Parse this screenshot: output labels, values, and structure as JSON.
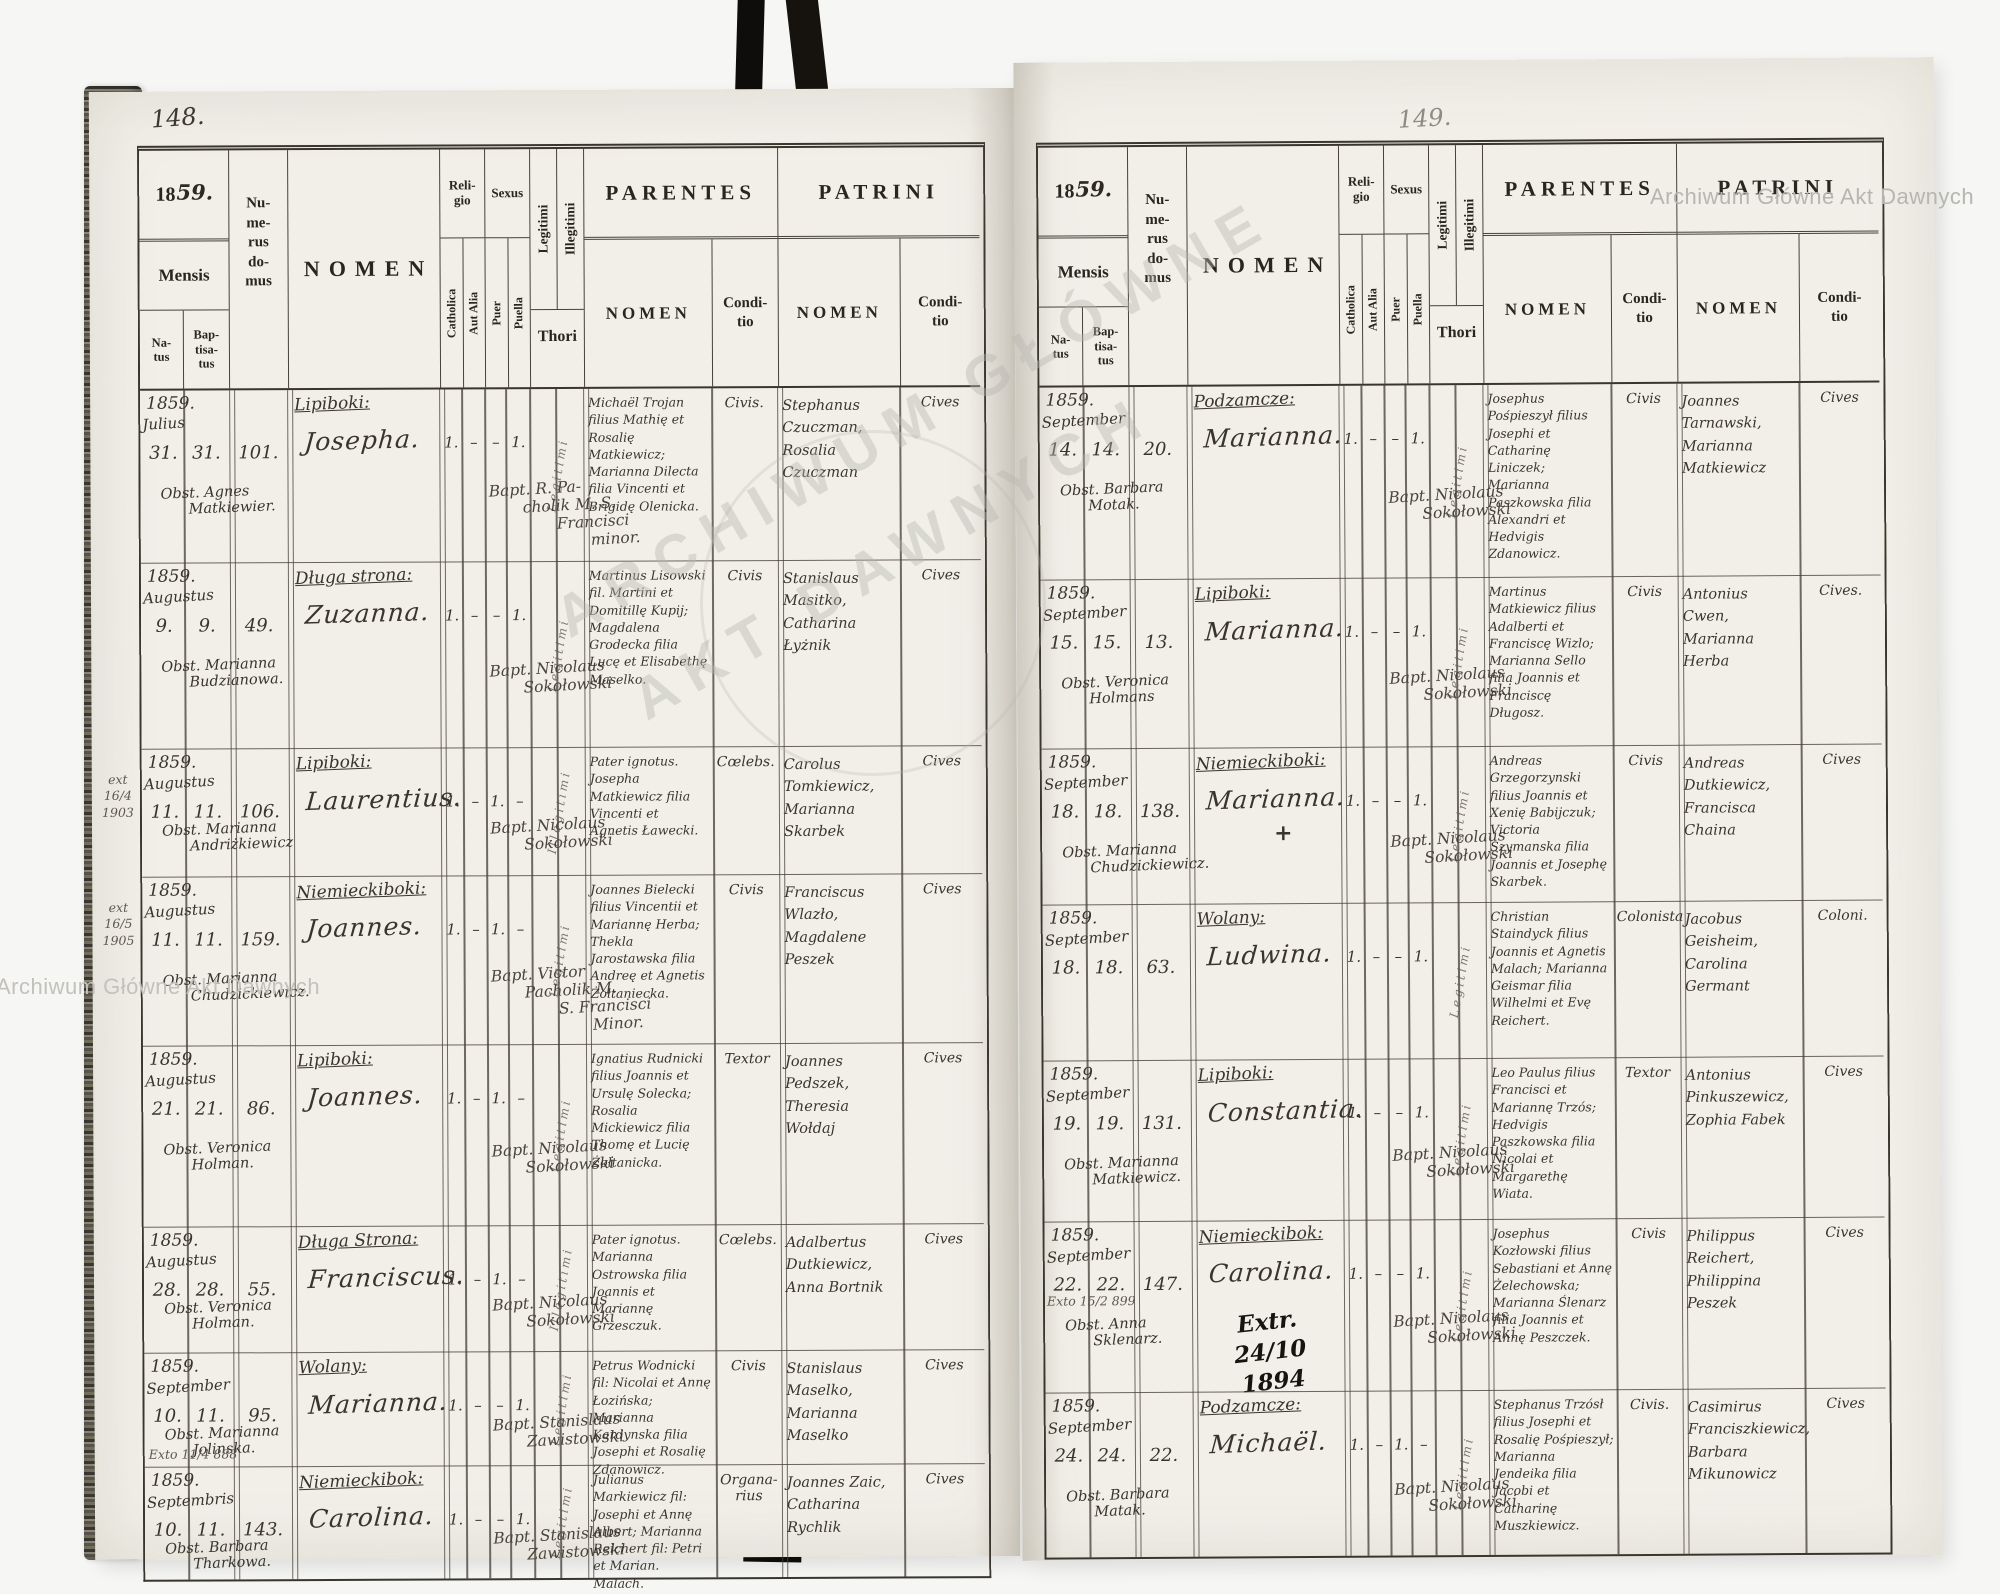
{
  "document_title": "Parish baptismal register 1859 (Latin), two-page spread",
  "colors": {
    "paper": "#f1efe8",
    "ink_print": "#29261f",
    "ink_hand": "#39352c",
    "watermark": "#b7b5b0"
  },
  "watermark": {
    "full": "Archiwum Główne Akt Dawnych",
    "center_line1": "ARCHIWUM GŁÓWNE",
    "center_line2": "AKT DAWNYCH"
  },
  "headers": {
    "year_printed": "18",
    "year_hand": "59.",
    "mensis": "Mensis",
    "natus_lines": [
      "Na-",
      "tus"
    ],
    "baptisatus_lines": [
      "Bap-",
      "tisa-",
      "tus"
    ],
    "numerus_domus_lines": [
      "Nu-",
      "me-",
      "rus",
      "do-",
      "mus"
    ],
    "nomen": "NOMEN",
    "religio_lines": [
      "Reli-",
      "gio"
    ],
    "catholica": "Catholica",
    "aut_alia": "Aut Alia",
    "sexus": "Sexus",
    "puer": "Puer",
    "puella": "Puella",
    "legitimi": "Legitimi",
    "illegitimi": "Illegitimi",
    "thori": "Thori",
    "parentes": "PARENTES",
    "patrini": "PATRINI",
    "conditio_lines": [
      "Condi-",
      "tio"
    ]
  },
  "left_page": {
    "page_number": "148.",
    "rows": [
      {
        "year": "1859.",
        "month": "Julius",
        "natus": "31.",
        "baptisatus": "31.",
        "domus": "101.",
        "locality": "Lipiboki:",
        "name": "Josepha.",
        "obstetrix": [
          "Obst. Agnes",
          "Matkiewier."
        ],
        "marks": {
          "catholica": "1.",
          "aut_alia": "–",
          "puer": "–",
          "puella": "1."
        },
        "thori_note": "Legitimi",
        "baptizer": [
          "Bapt. R. Pa-",
          "cholik M. S.",
          "Francisci",
          "minor."
        ],
        "parentes_nomen": "Michaël Trojan filius Mathię et Rosalię Matkiewicz; Marianna Dilecta filia Vincenti et Brigidę Olenicka.",
        "parentes_conditio": "Civis.",
        "patrini_nomen": "Stephanus Czuczman, Rosalia Czuczman",
        "patrini_conditio": "Cives"
      },
      {
        "year": "1859.",
        "month": "Augustus",
        "natus": "9.",
        "baptisatus": "9.",
        "domus": "49.",
        "locality": "Długa strona:",
        "name": "Zuzanna.",
        "obstetrix": [
          "Obst. Marianna",
          "Budzianowa."
        ],
        "marks": {
          "catholica": "1.",
          "aut_alia": "–",
          "puer": "–",
          "puella": "1."
        },
        "thori_note": "Legitimi",
        "baptizer": [
          "Bapt. Nicolaus",
          "Sokołowski"
        ],
        "parentes_nomen": "Martinus Lisowski fil. Martini et Domitillę Kupij; Magdalena Grodecka filia Lucę et Elisabethę Maselko.",
        "parentes_conditio": "Civis",
        "patrini_nomen": "Stanislaus Masitko, Catharina Łyżnik",
        "patrini_conditio": "Cives"
      },
      {
        "margin": {
          "lines": [
            "ext",
            "16/4",
            "1903"
          ],
          "placement": "side"
        },
        "year": "1859.",
        "month": "Augustus",
        "natus": "11.",
        "baptisatus": "11.",
        "domus": "106.",
        "locality": "Lipiboki:",
        "name": "Laurentius.",
        "obstetrix": [
          "Obst. Marianna",
          "Andriżkiewicz"
        ],
        "marks": {
          "catholica": "1.",
          "aut_alia": "–",
          "puer": "1.",
          "puella": "–"
        },
        "thori_note": "Illegitimi",
        "baptizer": [
          "Bapt. Nicolaus",
          "Sokołowski"
        ],
        "parentes_nomen": "Pater ignotus. Josepha Matkiewicz filia Vincenti et Agnetis Ławecki.",
        "parentes_conditio": "Cœlebs.",
        "patrini_nomen": "Carolus Tomkiewicz, Marianna Skarbek",
        "patrini_conditio": "Cives"
      },
      {
        "margin": {
          "lines": [
            "ext",
            "16/5",
            "1905"
          ],
          "placement": "side"
        },
        "year": "1859.",
        "month": "Augustus",
        "natus": "11.",
        "baptisatus": "11.",
        "domus": "159.",
        "locality": "Niemieckiboki:",
        "name": "Joannes.",
        "obstetrix": [
          "Obst. Marianna",
          "Chudzickiewicz."
        ],
        "marks": {
          "catholica": "1.",
          "aut_alia": "–",
          "puer": "1.",
          "puella": "–"
        },
        "thori_note": "Legitimi",
        "baptizer": [
          "Bapt. Victor",
          "Pacholik M.",
          "S. Francisci",
          "Minor."
        ],
        "parentes_nomen": "Joannes Bielecki filius Vincentii et Mariannę Herba; Thekla Jarostawska filia Andreę et Agnetis Żołtaniecka.",
        "parentes_conditio": "Civis",
        "patrini_nomen": "Franciscus Wlazło, Magdalene Peszek",
        "patrini_conditio": "Cives"
      },
      {
        "year": "1859.",
        "month": "Augustus",
        "natus": "21.",
        "baptisatus": "21.",
        "domus": "86.",
        "locality": "Lipiboki:",
        "name": "Joannes.",
        "obstetrix": [
          "Obst. Veronica",
          "Holman."
        ],
        "marks": {
          "catholica": "1.",
          "aut_alia": "–",
          "puer": "1.",
          "puella": "–"
        },
        "thori_note": "Legitimi",
        "baptizer": [
          "Bapt. Nicolaus",
          "Sokołowski"
        ],
        "parentes_nomen": "Ignatius Rudnicki filius Joannis et Ursulę Solecka; Rosalia Mickiewicz filia Thomę et Lucię Żołtanicka.",
        "parentes_conditio": "Textor",
        "patrini_nomen": "Joannes Pedszek, Theresia Wołdaj",
        "patrini_conditio": "Cives"
      },
      {
        "year": "1859.",
        "month": "Augustus",
        "natus": "28.",
        "baptisatus": "28.",
        "domus": "55.",
        "locality": "Długa Strona:",
        "name": "Franciscus.",
        "obstetrix": [
          "Obst. Veronica",
          "Holman."
        ],
        "marks": {
          "catholica": "1.",
          "aut_alia": "–",
          "puer": "1.",
          "puella": "–"
        },
        "thori_note": "Illegitimi",
        "baptizer": [
          "Bapt. Nicolaus",
          "Sokołowski"
        ],
        "parentes_nomen": "Pater ignotus. Marianna Ostrowska filia Joannis et Mariannę Grzesczuk.",
        "parentes_conditio": "Cœlebs.",
        "patrini_nomen": "Adalbertus Dutkiewicz, Anna Bortnik",
        "patrini_conditio": "Cives"
      },
      {
        "margin": {
          "lines": [
            "Exto 11/4 888"
          ],
          "placement": "below"
        },
        "year": "1859.",
        "month": "September",
        "natus": "10.",
        "baptisatus": "11.",
        "domus": "95.",
        "locality": "Wolany:",
        "name": "Marianna.",
        "obstetrix": [
          "Obst. Marianna",
          "Jolinska."
        ],
        "marks": {
          "catholica": "1.",
          "aut_alia": "–",
          "puer": "–",
          "puella": "1."
        },
        "thori_note": "Legitimi",
        "baptizer": [
          "Bapt. Stanislaus",
          "Zawistowski"
        ],
        "parentes_nomen": "Petrus Wodnicki fil: Nicolai et Annę Łozińska; Marianna Kardynska filia Josephi et Rosalię Zdanowicz.",
        "parentes_conditio": "Civis",
        "patrini_nomen": "Stanislaus Maselko, Marianna Maselko",
        "patrini_conditio": "Cives"
      },
      {
        "year": "1859.",
        "month": "Septembris",
        "natus": "10.",
        "baptisatus": "11.",
        "domus": "143.",
        "locality": "Niemieckibok:",
        "name": "Carolina.",
        "obstetrix": [
          "Obst. Barbara",
          "Tharkowa."
        ],
        "marks": {
          "catholica": "1.",
          "aut_alia": "–",
          "puer": "–",
          "puella": "1."
        },
        "thori_note": "Legitimi",
        "baptizer": [
          "Bapt. Stanislaus",
          "Zawistowski"
        ],
        "parentes_nomen": "Julianus Markiewicz fil: Josephi et Annę Albert; Marianna Reichert fil: Petri et Marian. Malach.",
        "parentes_conditio": "Organa- rius",
        "patrini_nomen": "Joannes Zaic, Catharina Rychlik",
        "patrini_conditio": "Cives"
      }
    ]
  },
  "right_page": {
    "page_number": "149.",
    "rows": [
      {
        "year": "1859.",
        "month": "September",
        "natus": "14.",
        "baptisatus": "14.",
        "domus": "20.",
        "locality": "Podzamcze:",
        "name": "Marianna.",
        "obstetrix": [
          "Obst. Barbara",
          "Motak."
        ],
        "marks": {
          "catholica": "1.",
          "aut_alia": "–",
          "puer": "–",
          "puella": "1."
        },
        "thori_note": "Legitimi",
        "baptizer": [
          "Bapt. Nicolaus",
          "Sokołowski"
        ],
        "parentes_nomen": "Josephus Pośpieszył filius Josephi et Catharinę Liniczek; Marianna Paszkowska filia Alexandri et Hedvigis Zdanowicz.",
        "parentes_conditio": "Civis",
        "patrini_nomen": "Joannes Tarnawski, Marianna Matkiewicz",
        "patrini_conditio": "Cives"
      },
      {
        "year": "1859.",
        "month": "September",
        "natus": "15.",
        "baptisatus": "15.",
        "domus": "13.",
        "locality": "Lipiboki:",
        "name": "Marianna.",
        "obstetrix": [
          "Obst. Veronica",
          "Holmans"
        ],
        "marks": {
          "catholica": "1.",
          "aut_alia": "–",
          "puer": "–",
          "puella": "1."
        },
        "thori_note": "Legitimi",
        "baptizer": [
          "Bapt. Nicolaus",
          "Sokołowski"
        ],
        "parentes_nomen": "Martinus Matkiewicz filius Adalberti et Franciscę Wizlo; Marianna Sello filia Joannis et Franciscę Długosz.",
        "parentes_conditio": "Civis",
        "patrini_nomen": "Antonius Cwen, Marianna Herba",
        "patrini_conditio": "Cives."
      },
      {
        "year": "1859.",
        "month": "September",
        "natus": "18.",
        "baptisatus": "18.",
        "domus": "138.",
        "locality": "Niemieckiboki:",
        "name": "Marianna.",
        "name_mark": "+",
        "obstetrix": [
          "Obst. Marianna",
          "Chudzickiewicz."
        ],
        "marks": {
          "catholica": "1.",
          "aut_alia": "–",
          "puer": "–",
          "puella": "1."
        },
        "thori_note": "Legitimi",
        "baptizer": [
          "Bapt. Nicolaus",
          "Sokołowski"
        ],
        "parentes_nomen": "Andreas Grzegorzynski filius Joannis et Xenię Babijczuk; Victoria Szymanska filia Joannis et Josephę Skarbek.",
        "parentes_conditio": "Civis",
        "patrini_nomen": "Andreas Dutkiewicz, Francisca Chaina",
        "patrini_conditio": "Cives"
      },
      {
        "year": "1859.",
        "month": "September",
        "natus": "18.",
        "baptisatus": "18.",
        "domus": "63.",
        "locality": "Wolany:",
        "name": "Ludwina.",
        "marks": {
          "catholica": "1.",
          "aut_alia": "–",
          "puer": "–",
          "puella": "1."
        },
        "thori_note": "Legitimi",
        "parentes_nomen": "Christian Staindyck filius Joannis et Agnetis Malach; Marianna Geismar filia Wilhelmi et Evę Reichert.",
        "parentes_conditio": "Colonista",
        "patrini_nomen": "Jacobus Geisheim, Carolina Germant",
        "patrini_conditio": "Coloni."
      },
      {
        "year": "1859.",
        "month": "September",
        "natus": "19.",
        "baptisatus": "19.",
        "domus": "131.",
        "locality": "Lipiboki:",
        "name": "Constantia.",
        "obstetrix": [
          "Obst. Marianna",
          "Matkiewicz."
        ],
        "marks": {
          "catholica": "1.",
          "aut_alia": "–",
          "puer": "–",
          "puella": "1."
        },
        "thori_note": "Legitimi",
        "baptizer": [
          "Bapt. Nicolaus",
          "Sokołowski"
        ],
        "parentes_nomen": "Leo Paulus filius Francisci et Mariannę Trzós; Hedvigis Paszkowska filia Nicolai et Margarethę Wiata.",
        "parentes_conditio": "Textor",
        "patrini_nomen": "Antonius Pinkuszewicz, Zophia Fabek",
        "patrini_conditio": "Cives"
      },
      {
        "margin": {
          "lines": [
            "Exto 15/2 899"
          ],
          "placement": "mid"
        },
        "year": "1859.",
        "month": "September",
        "natus": "22.",
        "baptisatus": "22.",
        "domus": "147.",
        "locality": "Niemieckibok:",
        "name": "Carolina.",
        "obstetrix": [
          "Obst. Anna",
          "Sklenarz."
        ],
        "extra": [
          "Extr.",
          "24/10",
          "1894"
        ],
        "marks": {
          "catholica": "1.",
          "aut_alia": "–",
          "puer": "–",
          "puella": "1."
        },
        "thori_note": "Legitimi",
        "baptizer": [
          "Bapt. Nicolaus",
          "Sokołowski"
        ],
        "parentes_nomen": "Josephus Kozłowski filius Sebastiani et Annę Żelechowska; Marianna Ślenarz filia Joannis et Annę Peszczek.",
        "parentes_conditio": "Civis",
        "patrini_nomen": "Philippus Reichert, Philippina Peszek",
        "patrini_conditio": "Cives"
      },
      {
        "year": "1859.",
        "month": "September",
        "natus": "24.",
        "baptisatus": "24.",
        "domus": "22.",
        "locality": "Podzamcze:",
        "name": "Michaël.",
        "obstetrix": [
          "Obst. Barbara",
          "Matak."
        ],
        "marks": {
          "catholica": "1.",
          "aut_alia": "–",
          "puer": "1.",
          "puella": "–"
        },
        "thori_note": "Legitimi",
        "baptizer": [
          "Bapt. Nicolaus",
          "Sokołowski"
        ],
        "parentes_nomen": "Stephanus Trzósł filius Josephi et Rosalię Pośpieszył; Marianna Jendeika filia Jacobi et Catharinę Muszkiewicz.",
        "parentes_conditio": "Civis.",
        "patrini_nomen": "Casimirus Franciszkiewicz, Barbara Mikunowicz",
        "patrini_conditio": "Cives"
      }
    ]
  }
}
